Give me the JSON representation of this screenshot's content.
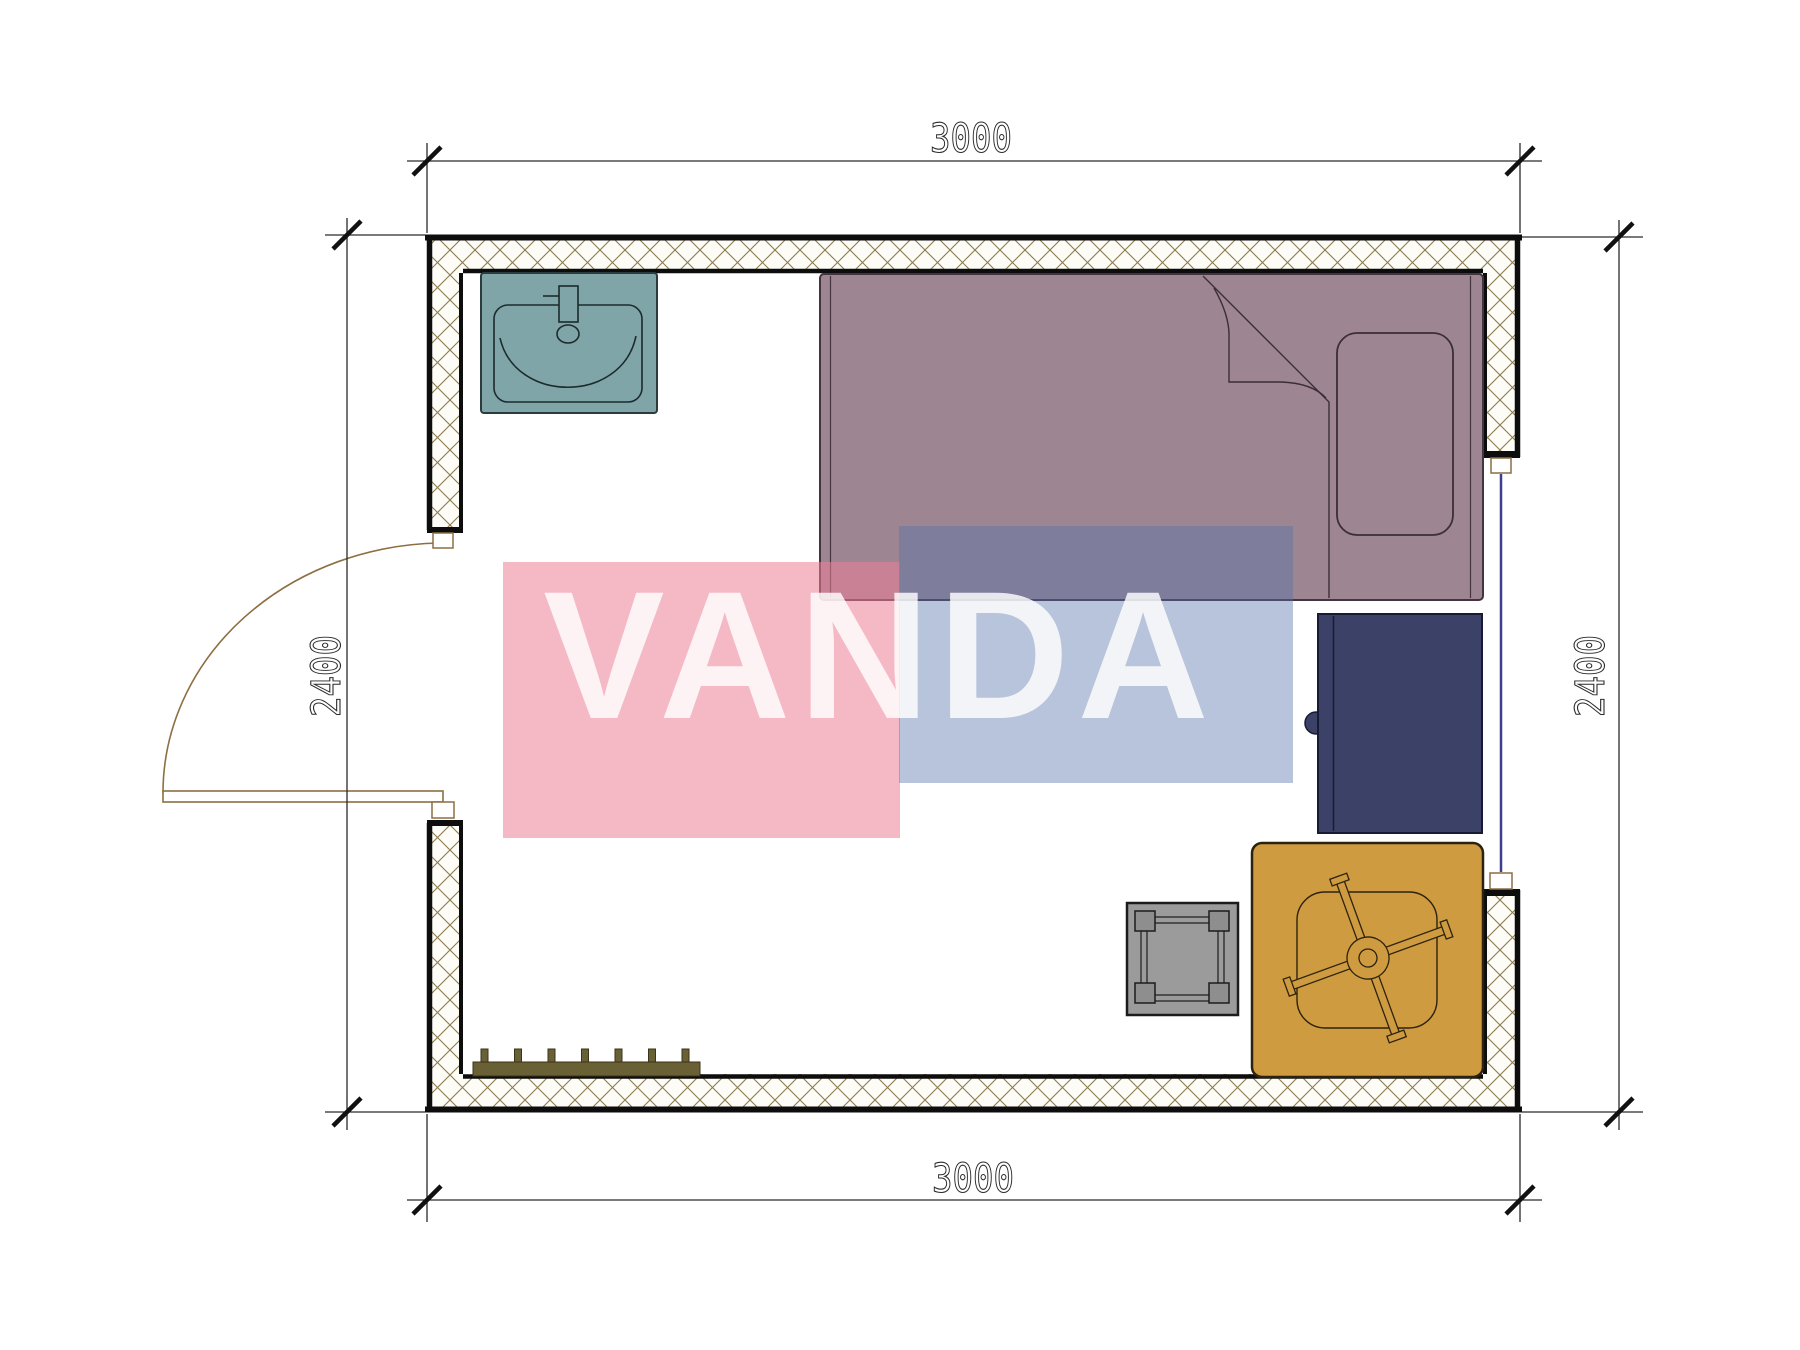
{
  "drawing": {
    "type": "room floor plan",
    "units": "mm"
  },
  "dimensions": {
    "top_width": "3000",
    "bottom_width": "3000",
    "left_height": "2400",
    "right_height": "2400"
  },
  "watermark": {
    "text": "VANDA",
    "pink_color": "#ec7f97",
    "blue_color": "#5472aa",
    "text_color": "#ffffff"
  },
  "colors": {
    "wall_hatch": "#8c7b4e",
    "wall_fill": "#fdfcf7",
    "wall_border": "#0d0d0d",
    "dim": "#2a2a2a",
    "door": "#8c6f42",
    "window": "#3f3f8f",
    "sink": "#7fa5a9",
    "sink_line": "#1d2b2b",
    "bed": "#9d8692",
    "bed_line": "#443440",
    "cabinet": "#3c4168",
    "cabinet_line": "#181b33",
    "table": "#cf9b40",
    "table_line": "#2c220e",
    "stool": "#9b9b9b",
    "stool_block": "#8e8e8e",
    "stool_line": "#1c1c1c",
    "radiator": "#6a6036",
    "radiator_line": "#3a3418"
  },
  "furniture": {
    "sink": "washbasin",
    "bed": "single-bed",
    "pillow": "pillow",
    "cabinet": "bedside-cabinet",
    "table": "table-with-swivel-chair",
    "stool": "stool",
    "radiator": "radiator",
    "door": "entrance-door",
    "window": "window"
  }
}
